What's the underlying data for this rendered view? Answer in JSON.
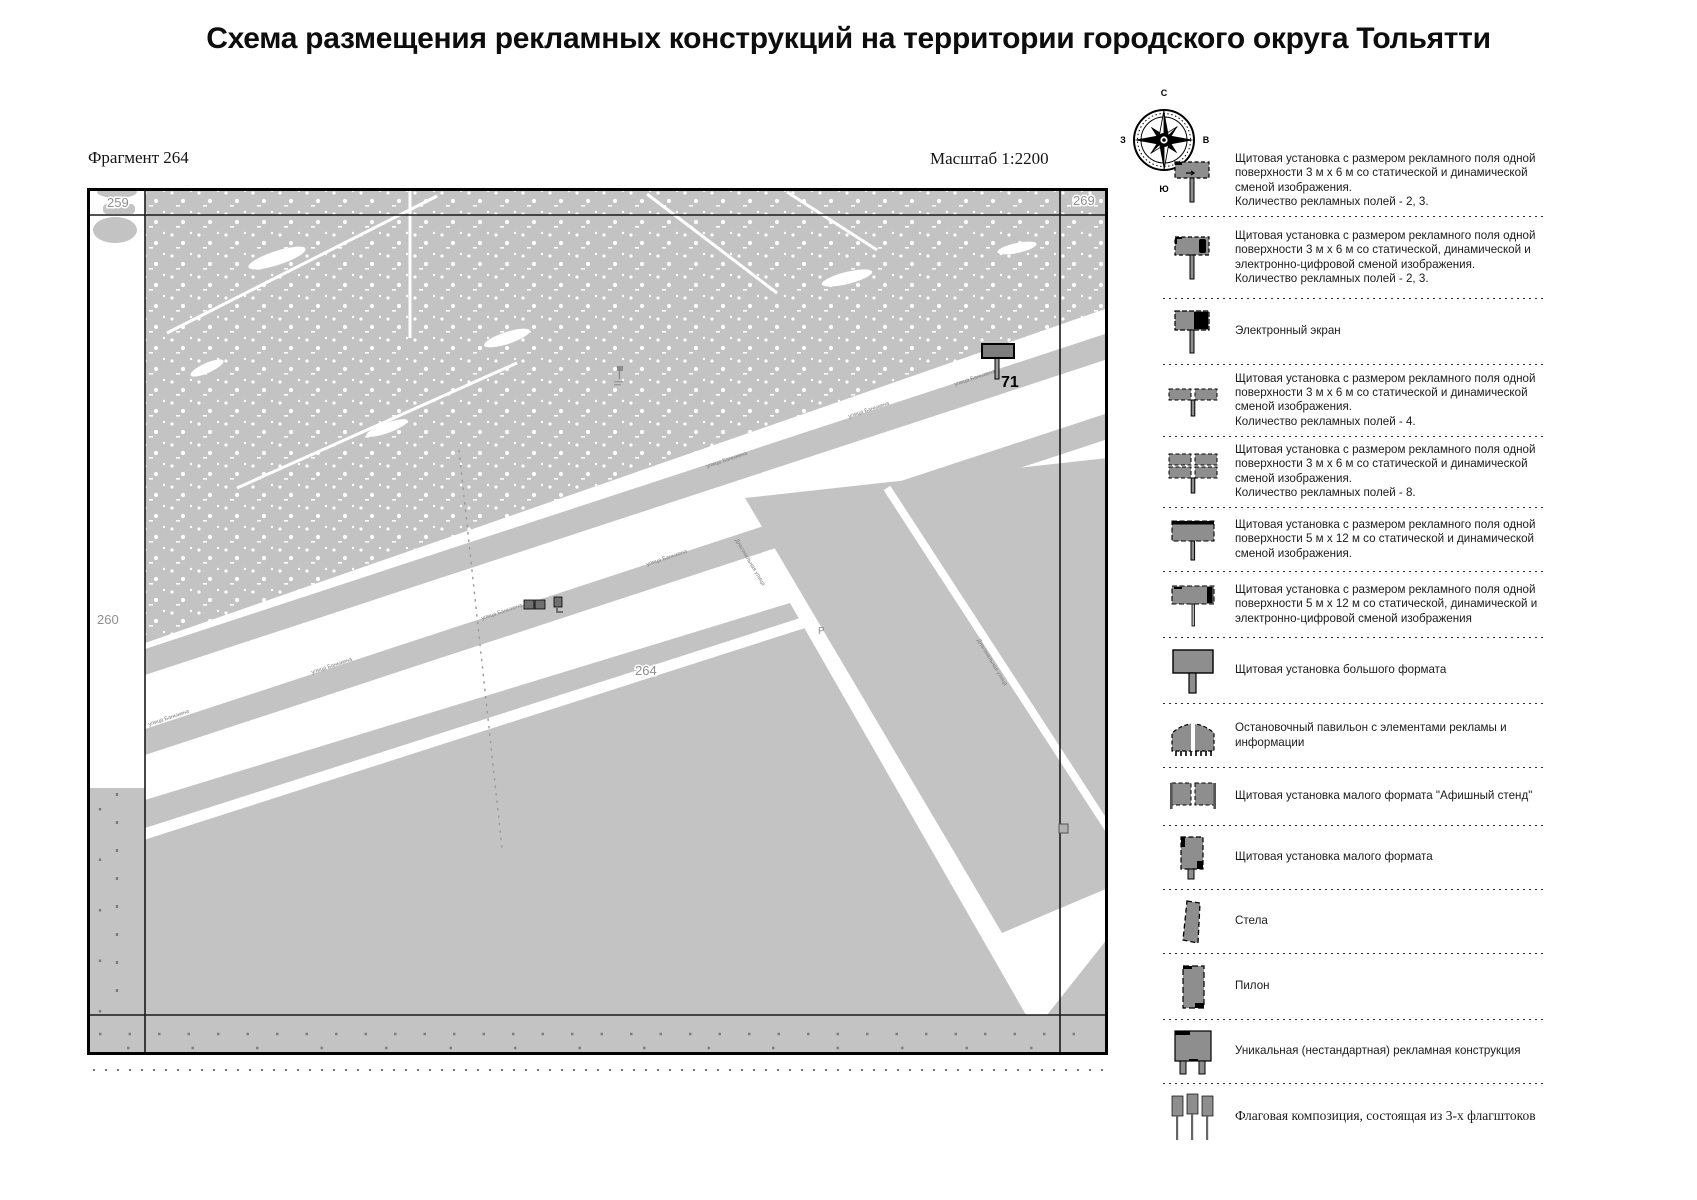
{
  "title": "Схема размещения рекламных конструкций на территории городского округа Тольятти",
  "map": {
    "fragment_label": "Фрагмент 264",
    "scale_label": "Масштаб 1:2200",
    "corner_labels": {
      "top_left": "259",
      "top_right": "269",
      "left": "260",
      "center": "264"
    },
    "marker": {
      "number": "71"
    },
    "streets": {
      "banykina": "улица Баныкина",
      "diagonalnaya": "Диагональная улица"
    },
    "symbols": {
      "parking": "Р"
    },
    "colors": {
      "block_gray": "#c3c3c3",
      "icon_gray": "#8e8e8e"
    }
  },
  "compass": {
    "north": "С",
    "south": "Ю",
    "east": "В",
    "west": "З"
  },
  "legend": {
    "items": [
      {
        "icon": "billboard-3x6-static-icon",
        "text": "Щитовая установка с размером рекламного поля одной поверхности 3 м х 6 м со статической и динамической сменой изображения.\nКоличество рекламных полей - 2, 3."
      },
      {
        "icon": "billboard-3x6-digital-icon",
        "text": "Щитовая установка с размером рекламного поля одной поверхности 3 м х 6 м со статической, динамической и электронно-цифровой сменой изображения.\nКоличество рекламных полей - 2, 3."
      },
      {
        "icon": "electronic-screen-icon",
        "text": "Электронный экран"
      },
      {
        "icon": "billboard-3x6-4fields-icon",
        "text": "Щитовая установка с размером рекламного поля одной поверхности 3 м х 6 м со статической и динамической сменой изображения.\nКоличество рекламных полей - 4."
      },
      {
        "icon": "billboard-3x6-8fields-icon",
        "text": "Щитовая установка с размером рекламного поля одной поверхности 3 м х 6 м со статической и динамической сменой изображения.\nКоличество рекламных полей - 8."
      },
      {
        "icon": "billboard-5x12-static-icon",
        "text": "Щитовая установка с размером рекламного поля одной поверхности 5 м х 12 м со статической и динамической сменой изображения."
      },
      {
        "icon": "billboard-5x12-digital-icon",
        "text": "Щитовая установка с размером рекламного поля одной поверхности 5 м х 12 м со статической, динамической и электронно-цифровой сменой изображения"
      },
      {
        "icon": "large-format-billboard-icon",
        "text": "Щитовая установка большого формата"
      },
      {
        "icon": "bus-stop-pavilion-icon",
        "text": "Остановочный павильон с элементами рекламы и информации"
      },
      {
        "icon": "poster-stand-icon",
        "text": "Щитовая установка малого формата \"Афишный стенд\""
      },
      {
        "icon": "small-format-billboard-icon",
        "text": "Щитовая установка малого формата"
      },
      {
        "icon": "stela-icon",
        "text": "Стела"
      },
      {
        "icon": "pylon-icon",
        "text": "Пилон"
      },
      {
        "icon": "unique-construction-icon",
        "text": "Уникальная (нестандартная) рекламная конструкция"
      },
      {
        "icon": "flag-composition-icon",
        "text": "Флаговая композиция, состоящая из 3-х флагштоков"
      }
    ]
  }
}
